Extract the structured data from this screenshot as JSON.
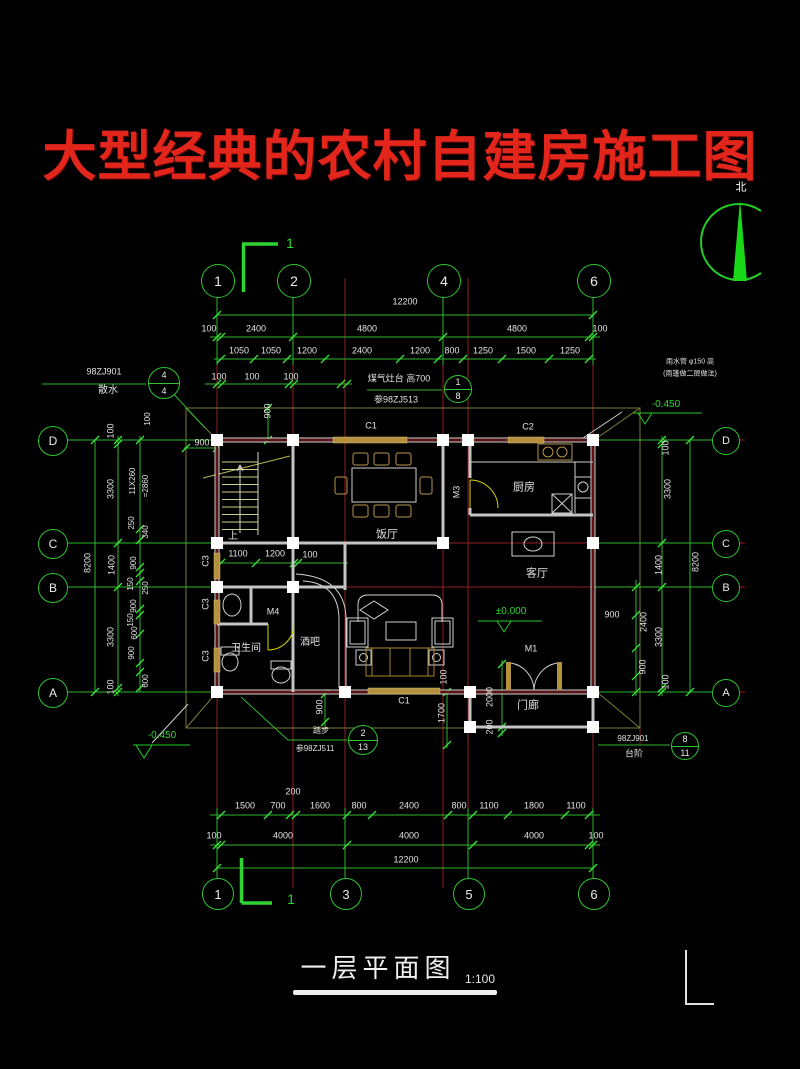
{
  "title": {
    "text": "大型经典的农村自建房施工图",
    "color": "#e2261c"
  },
  "drawing_title": {
    "text": "一层平面图",
    "scale": "1:100"
  },
  "colors": {
    "dim_green": "#2db82d",
    "grid_red": "#8f1f1f",
    "wall_white": "#d9d9d9",
    "window_tan": "#b5913e",
    "door_yellow": "#d6d600",
    "title_red": "#e2261c"
  },
  "north_arrow": {
    "label": "北"
  },
  "grid_bubbles": [
    {
      "l": "1",
      "x": 217,
      "y": 280,
      "r": 16
    },
    {
      "l": "2",
      "x": 293,
      "y": 280,
      "r": 16
    },
    {
      "l": "4",
      "x": 443,
      "y": 280,
      "r": 16
    },
    {
      "l": "6",
      "x": 593,
      "y": 280,
      "r": 16
    },
    {
      "l": "1",
      "x": 217,
      "y": 893,
      "r": 15
    },
    {
      "l": "3",
      "x": 345,
      "y": 893,
      "r": 15
    },
    {
      "l": "5",
      "x": 468,
      "y": 893,
      "r": 15
    },
    {
      "l": "6",
      "x": 593,
      "y": 893,
      "r": 15
    },
    {
      "l": "D",
      "x": 52,
      "y": 440,
      "r": 14
    },
    {
      "l": "C",
      "x": 52,
      "y": 543,
      "r": 14
    },
    {
      "l": "B",
      "x": 52,
      "y": 587,
      "r": 14
    },
    {
      "l": "A",
      "x": 52,
      "y": 692,
      "r": 14
    },
    {
      "l": "D",
      "x": 725,
      "y": 440,
      "r": 13
    },
    {
      "l": "C",
      "x": 725,
      "y": 543,
      "r": 13
    },
    {
      "l": "B",
      "x": 725,
      "y": 587,
      "r": 13
    },
    {
      "l": "A",
      "x": 725,
      "y": 692,
      "r": 13
    }
  ],
  "detail_bubbles": [
    {
      "a": "1",
      "b": "8",
      "x": 457,
      "y": 388,
      "r": 13
    },
    {
      "a": "4",
      "b": "4",
      "x": 163,
      "y": 382,
      "r": 15
    },
    {
      "a": "2",
      "b": "13",
      "x": 362,
      "y": 739,
      "r": 14
    },
    {
      "a": "8",
      "b": "11",
      "x": 684,
      "y": 745,
      "r": 13
    }
  ],
  "annotations": [
    {
      "n": "dim-overall-top",
      "t": "12200",
      "x": 405,
      "y": 302
    },
    {
      "t": "100",
      "x": 209,
      "y": 329
    },
    {
      "t": "2400",
      "x": 256,
      "y": 329
    },
    {
      "t": "4800",
      "x": 367,
      "y": 329
    },
    {
      "t": "4800",
      "x": 517,
      "y": 329
    },
    {
      "t": "100",
      "x": 600,
      "y": 329
    },
    {
      "t": "1050",
      "x": 239,
      "y": 351
    },
    {
      "t": "1050",
      "x": 271,
      "y": 351
    },
    {
      "t": "1200",
      "x": 307,
      "y": 351
    },
    {
      "t": "2400",
      "x": 362,
      "y": 351
    },
    {
      "t": "1200",
      "x": 420,
      "y": 351
    },
    {
      "t": "800",
      "x": 452,
      "y": 351
    },
    {
      "t": "1250",
      "x": 483,
      "y": 351
    },
    {
      "t": "1500",
      "x": 526,
      "y": 351
    },
    {
      "t": "1250",
      "x": 570,
      "y": 351
    },
    {
      "t": "100",
      "x": 219,
      "y": 377
    },
    {
      "t": "100",
      "x": 252,
      "y": 377
    },
    {
      "t": "100",
      "x": 291,
      "y": 377
    },
    {
      "n": "note-gas-stove",
      "t": "煤气灶台 高700",
      "x": 399,
      "y": 379
    },
    {
      "n": "note-ref-98zj513",
      "t": "参98ZJ513",
      "x": 396,
      "y": 400
    },
    {
      "n": "note-ref-98zj901",
      "t": "98ZJ901",
      "x": 104,
      "y": 372
    },
    {
      "n": "note-apron",
      "t": "散水",
      "x": 108,
      "y": 391,
      "s": 10
    },
    {
      "n": "north-label",
      "t": "北",
      "x": 741,
      "y": 188,
      "s": 11,
      "c": "#ffffff"
    },
    {
      "n": "note-downpipe",
      "t": "雨水管 φ150 高",
      "x": 690,
      "y": 362,
      "s": 7
    },
    {
      "n": "note-downpipe2",
      "t": "(雨篷做二层做法)",
      "x": 690,
      "y": 374,
      "s": 7
    },
    {
      "n": "elev-minus-0450-right",
      "t": "-0.450",
      "x": 666,
      "y": 405,
      "s": 10,
      "c": "#2fd42f"
    },
    {
      "n": "elev-minus-0450-left",
      "t": "-0.450",
      "x": 162,
      "y": 736,
      "s": 10,
      "c": "#2fd42f"
    },
    {
      "n": "elev-zero",
      "t": "±0.000",
      "x": 511,
      "y": 612,
      "s": 10,
      "c": "#2fd42f"
    },
    {
      "t": "8200",
      "x": 88,
      "y": 563,
      "r": -90
    },
    {
      "t": "100",
      "x": 111,
      "y": 431,
      "r": -90
    },
    {
      "t": "3300",
      "x": 111,
      "y": 489,
      "r": -90
    },
    {
      "t": "1400",
      "x": 112,
      "y": 565,
      "r": -90
    },
    {
      "t": "3300",
      "x": 111,
      "y": 637,
      "r": -90
    },
    {
      "t": "100",
      "x": 111,
      "y": 687,
      "r": -90
    },
    {
      "n": "stair-note",
      "t": "11X260",
      "x": 133,
      "y": 481,
      "r": -90,
      "s": 8
    },
    {
      "n": "stair-note2",
      "t": "=2860",
      "x": 146,
      "y": 486,
      "r": -90,
      "s": 8
    },
    {
      "t": "250",
      "x": 132,
      "y": 523,
      "r": -90,
      "s": 8
    },
    {
      "t": "340",
      "x": 146,
      "y": 532,
      "r": -90,
      "s": 8
    },
    {
      "t": "900",
      "x": 134,
      "y": 563,
      "r": -90,
      "s": 8
    },
    {
      "t": "150",
      "x": 131,
      "y": 584,
      "r": -90,
      "s": 8
    },
    {
      "t": "250",
      "x": 146,
      "y": 588,
      "r": -90,
      "s": 8
    },
    {
      "t": "900",
      "x": 134,
      "y": 606,
      "r": -90,
      "s": 8
    },
    {
      "t": "150",
      "x": 131,
      "y": 620,
      "r": -90,
      "s": 8
    },
    {
      "t": "600",
      "x": 135,
      "y": 633,
      "r": -90,
      "s": 8
    },
    {
      "t": "900",
      "x": 132,
      "y": 653,
      "r": -90,
      "s": 8
    },
    {
      "t": "600",
      "x": 146,
      "y": 681,
      "r": -90,
      "s": 8
    },
    {
      "t": "100",
      "x": 148,
      "y": 419,
      "r": -90,
      "s": 8
    },
    {
      "t": "3300",
      "x": 668,
      "y": 489,
      "r": -90
    },
    {
      "t": "1400",
      "x": 659,
      "y": 565,
      "r": -90
    },
    {
      "t": "8200",
      "x": 696,
      "y": 562,
      "r": -90
    },
    {
      "t": "3300",
      "x": 659,
      "y": 637,
      "r": -90
    },
    {
      "t": "2400",
      "x": 644,
      "y": 622,
      "r": -90
    },
    {
      "t": "900",
      "x": 643,
      "y": 667,
      "r": -90
    },
    {
      "t": "100",
      "x": 666,
      "y": 682,
      "r": -90
    },
    {
      "t": "100",
      "x": 666,
      "y": 448,
      "r": -90
    },
    {
      "t": "900",
      "x": 612,
      "y": 615
    },
    {
      "t": "900",
      "x": 268,
      "y": 411,
      "r": -90
    },
    {
      "t": "900",
      "x": 202,
      "y": 443
    },
    {
      "t": "1100",
      "x": 238,
      "y": 554
    },
    {
      "t": "1200",
      "x": 275,
      "y": 554
    },
    {
      "t": "100",
      "x": 310,
      "y": 555
    },
    {
      "n": "window-c1-top",
      "t": "C1",
      "x": 371,
      "y": 426
    },
    {
      "n": "window-c2",
      "t": "C2",
      "x": 528,
      "y": 427
    },
    {
      "n": "window-c1-bottom",
      "t": "C1",
      "x": 404,
      "y": 701
    },
    {
      "n": "window-c3",
      "t": "C3",
      "x": 206,
      "y": 561,
      "r": -90
    },
    {
      "n": "window-c3",
      "t": "C3",
      "x": 206,
      "y": 604,
      "r": -90
    },
    {
      "n": "window-c3",
      "t": "C3",
      "x": 206,
      "y": 656,
      "r": -90
    },
    {
      "n": "door-m3",
      "t": "M3",
      "x": 457,
      "y": 492,
      "r": -90
    },
    {
      "n": "door-m4",
      "t": "M4",
      "x": 273,
      "y": 612
    },
    {
      "n": "door-m1",
      "t": "M1",
      "x": 531,
      "y": 649
    },
    {
      "n": "stair-up",
      "t": "上",
      "x": 233,
      "y": 537,
      "s": 10
    },
    {
      "n": "room-dining",
      "t": "饭厅",
      "x": 387,
      "y": 535,
      "s": 11
    },
    {
      "n": "room-kitchen",
      "t": "厨房",
      "x": 524,
      "y": 488,
      "s": 11
    },
    {
      "n": "room-living",
      "t": "客厅",
      "x": 537,
      "y": 574,
      "s": 11
    },
    {
      "n": "room-bathroom",
      "t": "卫生间",
      "x": 246,
      "y": 649,
      "s": 10
    },
    {
      "n": "room-bar",
      "t": "酒吧",
      "x": 310,
      "y": 643,
      "s": 10
    },
    {
      "n": "room-porch",
      "t": "门廊",
      "x": 528,
      "y": 706,
      "s": 11
    },
    {
      "t": "2000",
      "x": 490,
      "y": 697,
      "r": -90
    },
    {
      "t": "200",
      "x": 490,
      "y": 727,
      "r": -90
    },
    {
      "t": "900",
      "x": 320,
      "y": 707,
      "r": -90
    },
    {
      "t": "1700",
      "x": 442,
      "y": 713,
      "r": -90
    },
    {
      "t": "100",
      "x": 444,
      "y": 677,
      "r": -90
    },
    {
      "n": "note-step-detail",
      "t": "踏步",
      "x": 321,
      "y": 731,
      "s": 8
    },
    {
      "n": "note-ref-98zj511",
      "t": "参98ZJ511",
      "x": 315,
      "y": 749,
      "s": 8
    },
    {
      "n": "note-ref-98zj901-steps",
      "t": "98ZJ901",
      "x": 633,
      "y": 739,
      "s": 8
    },
    {
      "n": "note-steps",
      "t": "台阶",
      "x": 634,
      "y": 754,
      "s": 9
    },
    {
      "t": "1500",
      "x": 245,
      "y": 806
    },
    {
      "t": "700",
      "x": 278,
      "y": 806
    },
    {
      "t": "200",
      "x": 293,
      "y": 792
    },
    {
      "t": "1600",
      "x": 320,
      "y": 806
    },
    {
      "t": "800",
      "x": 359,
      "y": 806
    },
    {
      "t": "2400",
      "x": 409,
      "y": 806
    },
    {
      "t": "800",
      "x": 459,
      "y": 806
    },
    {
      "t": "1100",
      "x": 489,
      "y": 806
    },
    {
      "t": "1800",
      "x": 534,
      "y": 806
    },
    {
      "t": "1100",
      "x": 576,
      "y": 806
    },
    {
      "t": "100",
      "x": 214,
      "y": 836
    },
    {
      "t": "4000",
      "x": 283,
      "y": 836
    },
    {
      "t": "4000",
      "x": 409,
      "y": 836
    },
    {
      "t": "4000",
      "x": 534,
      "y": 836
    },
    {
      "t": "100",
      "x": 596,
      "y": 836
    },
    {
      "n": "dim-overall-bottom",
      "t": "12200",
      "x": 406,
      "y": 860
    },
    {
      "n": "section-mark-label",
      "t": "1",
      "x": 290,
      "y": 243,
      "s": 14,
      "c": "#2fd42f"
    },
    {
      "n": "section-mark-label",
      "t": "1",
      "x": 291,
      "y": 899,
      "s": 14,
      "c": "#2fd42f"
    }
  ]
}
